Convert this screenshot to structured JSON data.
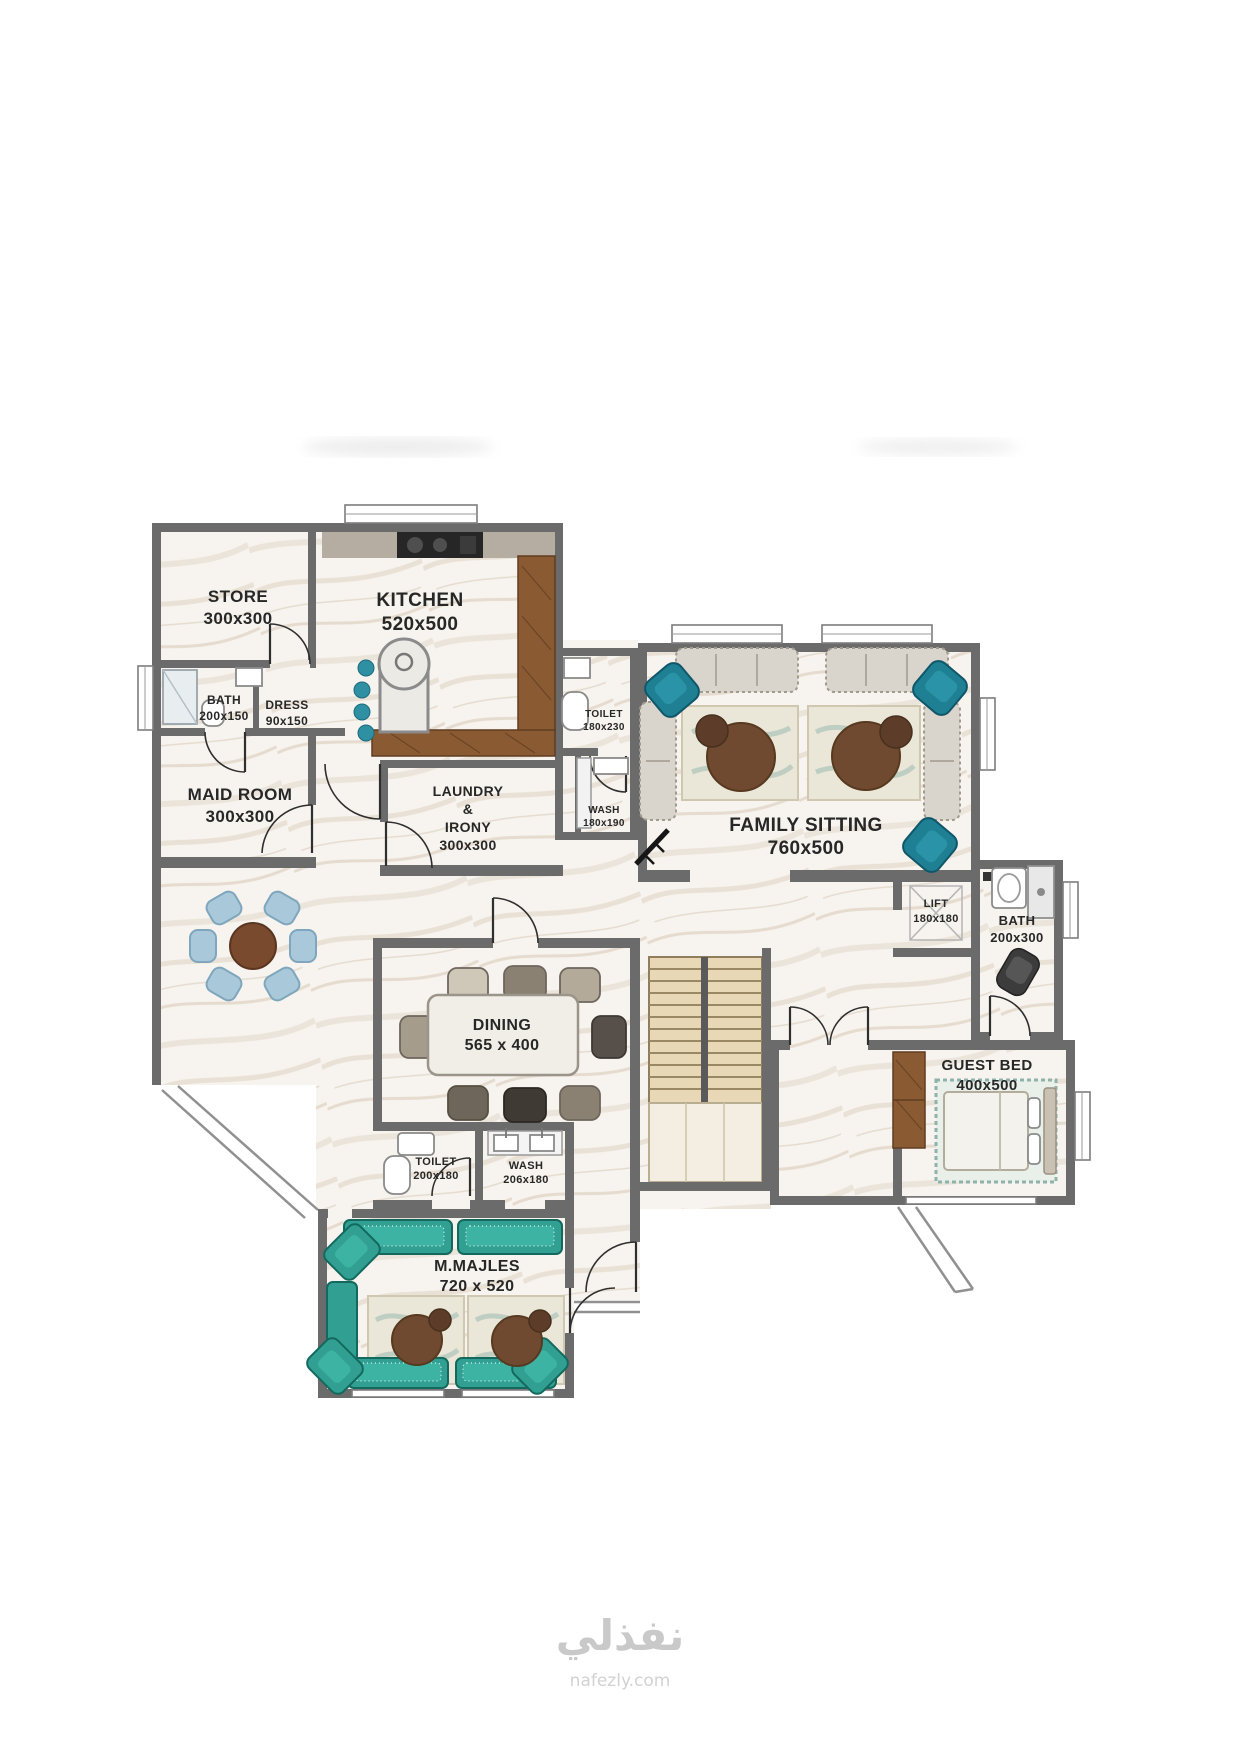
{
  "rooms": {
    "store": {
      "name": "STORE",
      "dims": "300x300"
    },
    "kitchen": {
      "name": "KITCHEN",
      "dims": "520x500"
    },
    "maid_bath": {
      "name": "BATH",
      "dims": "200x150"
    },
    "dress": {
      "name": "DRESS",
      "dims": "90x150"
    },
    "maid_room": {
      "name": "MAID ROOM",
      "dims": "300x300"
    },
    "laundry": {
      "name_line1": "LAUNDRY",
      "name_line2": "&",
      "name_line3": "IRONY",
      "dims": "300x300"
    },
    "toilet_upper": {
      "name": "TOILET",
      "dims": "180x230"
    },
    "wash_upper": {
      "name": "WASH",
      "dims": "180x190"
    },
    "family_sitting": {
      "name": "FAMILY SITTING",
      "dims": "760x500"
    },
    "lift": {
      "name": "LIFT",
      "dims": "180x180"
    },
    "bath": {
      "name": "BATH",
      "dims": "200x300"
    },
    "dining": {
      "name": "DINING",
      "dims": "565 x 400"
    },
    "guest_bed": {
      "name": "GUEST BED",
      "dims": "400x500"
    },
    "toilet_lower": {
      "name": "TOILET",
      "dims": "200x180"
    },
    "wash_lower": {
      "name": "WASH",
      "dims": "206x180"
    },
    "majles": {
      "name": "M.MAJLES",
      "dims": "720 x 520"
    }
  },
  "watermark": {
    "logo": "نفذلي",
    "site": "nafezly.com"
  },
  "colors": {
    "wall": "#6b6b6b",
    "floor": "#f7f3ee",
    "wood": "#8a5a33",
    "teal_sofa": "#31a093",
    "teal_chair": "#1f7f93",
    "gray_sofa": "#d9d4cc",
    "table_wood": "#6f4a31",
    "stairs": "#e9d8b5",
    "blue_chair": "#a9c9db",
    "watermark_gray": "#c9c9c9"
  }
}
